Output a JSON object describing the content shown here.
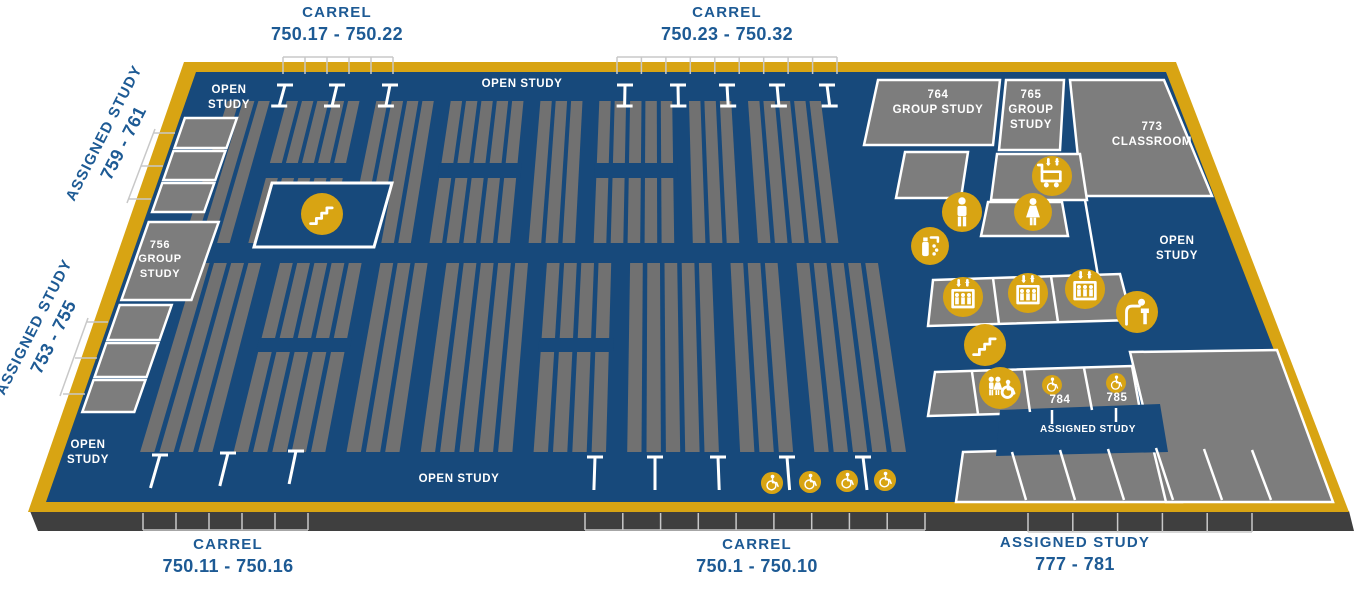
{
  "colors": {
    "navy": "#17497B",
    "gold": "#D8A413",
    "room_gray": "#7D7D7D",
    "stack_gray": "#717171",
    "edge_dark": "#3F3F3F",
    "label_blue": "#1D5A94",
    "line_gray": "#C8C8C8",
    "white": "#FFFFFF"
  },
  "outside_labels": {
    "carrel_top_left": {
      "line1": "CARREL",
      "line2": "750.17 - 750.22"
    },
    "carrel_top_center": {
      "line1": "CARREL",
      "line2": "750.23 - 750.32"
    },
    "carrel_bottom_left": {
      "line1": "CARREL",
      "line2": "750.11 - 750.16"
    },
    "carrel_bottom_center": {
      "line1": "CARREL",
      "line2": "750.1 - 750.10"
    },
    "assigned_bottom_right": {
      "line1": "ASSIGNED STUDY",
      "line2": "777 - 781"
    },
    "assigned_left_upper": {
      "line1": "ASSIGNED STUDY",
      "line2": "759 - 761"
    },
    "assigned_left_lower": {
      "line1": "ASSIGNED STUDY",
      "line2": "753 - 755"
    }
  },
  "floor_labels": {
    "open_study_top_left": {
      "line1": "OPEN",
      "line2": "STUDY"
    },
    "open_study_top_center": {
      "text": "OPEN STUDY"
    },
    "open_study_bottom_left": {
      "line1": "OPEN",
      "line2": "STUDY"
    },
    "open_study_bottom_center": {
      "text": "OPEN STUDY"
    },
    "open_study_right": {
      "line1": "OPEN",
      "line2": "STUDY"
    },
    "group_study_756": {
      "line1": "756",
      "line2": "GROUP",
      "line3": "STUDY"
    },
    "group_study_764": {
      "line1": "764",
      "line2": "GROUP STUDY"
    },
    "group_study_765": {
      "line1": "765",
      "line2": "GROUP",
      "line3": "STUDY"
    },
    "classroom_773": {
      "line1": "773",
      "line2": "CLASSROOM"
    },
    "room_784": {
      "text": "784"
    },
    "room_785": {
      "text": "785"
    },
    "assigned_study_band": {
      "text": "ASSIGNED STUDY"
    }
  },
  "icons": {
    "stairs": "stairs",
    "mens_restroom": "men's restroom",
    "womens_restroom": "women's restroom",
    "book_cart": "book return cart",
    "bottle_filling": "water bottle filling station",
    "elevator": "elevator",
    "drinking_fountain": "drinking fountain",
    "family_restroom": "all-gender accessible restroom",
    "accessible": "wheelchair accessible carrel / room"
  }
}
